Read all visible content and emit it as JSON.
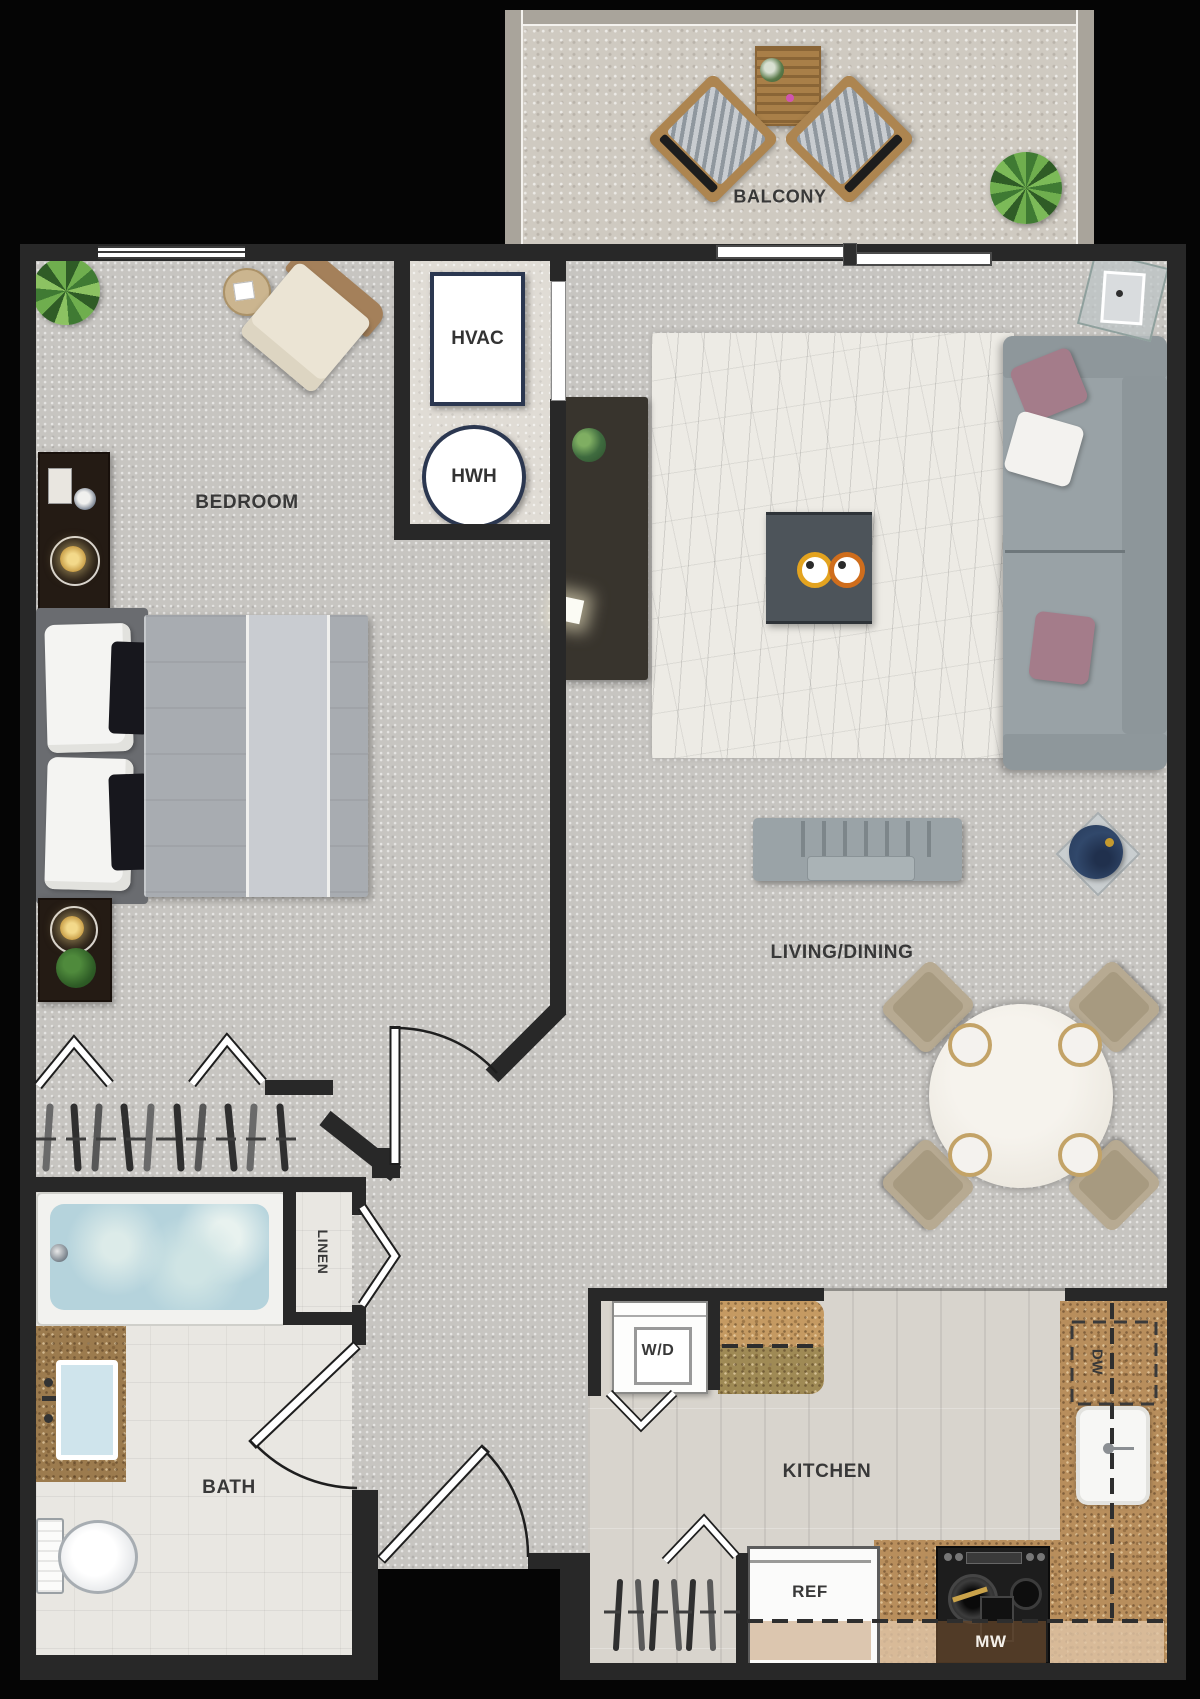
{
  "plan": {
    "rooms": {
      "balcony": "BALCONY",
      "bedroom": "BEDROOM",
      "living_dining": "LIVING/DINING",
      "kitchen": "KITCHEN",
      "bath": "BATH",
      "linen": "LINEN"
    },
    "equipment": {
      "hvac": "HVAC",
      "hwh": "HWH",
      "washer_dryer": "W/D",
      "dishwasher": "DW",
      "refrigerator": "REF",
      "microwave": "MW"
    },
    "colors": {
      "wall": "#282828",
      "carpet": "#c7c5c1",
      "tile": "#e9e7e2",
      "wood": "#d8d4cd",
      "granite": "#b88e5c",
      "accent_navy": "#2b3750",
      "label": "#383838"
    }
  }
}
